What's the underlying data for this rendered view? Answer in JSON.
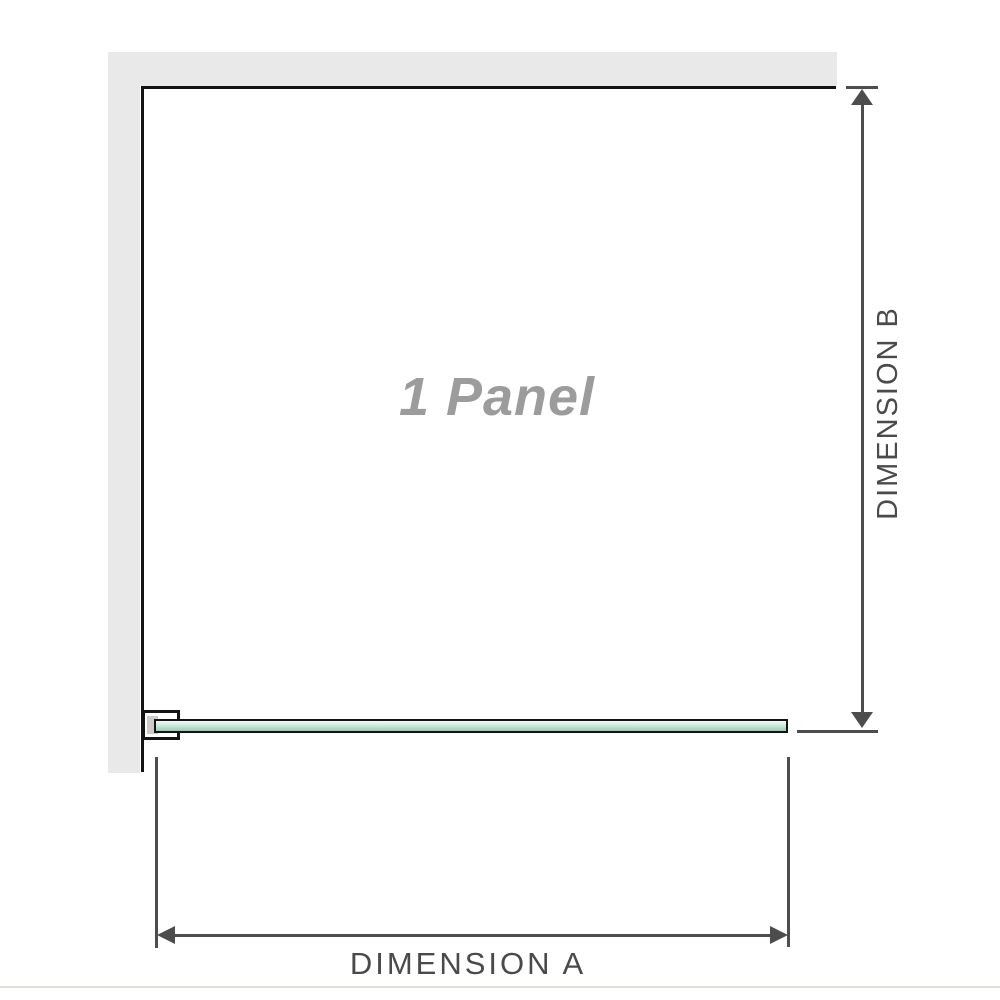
{
  "labels": {
    "panel": "1 Panel",
    "dimension_a": "DIMENSION A",
    "dimension_b": "DIMENSION B"
  },
  "colors": {
    "wall-fill": "#e9e9e9",
    "panel-outline": "#141414",
    "dimension-line": "#4d4d4d",
    "dimension-text": "#4a4a4a",
    "panel-text": "#9c9c9c",
    "glass-border": "#141414",
    "glass-light": "#f2faf5",
    "glass-mid": "#cfe9da",
    "glass-green": "#a8dabe",
    "glass-deep": "#93ceac",
    "bracket-fill": "#ffffff",
    "bracket-shadow": "#cccccc",
    "baseline": "#e2dfd9"
  }
}
